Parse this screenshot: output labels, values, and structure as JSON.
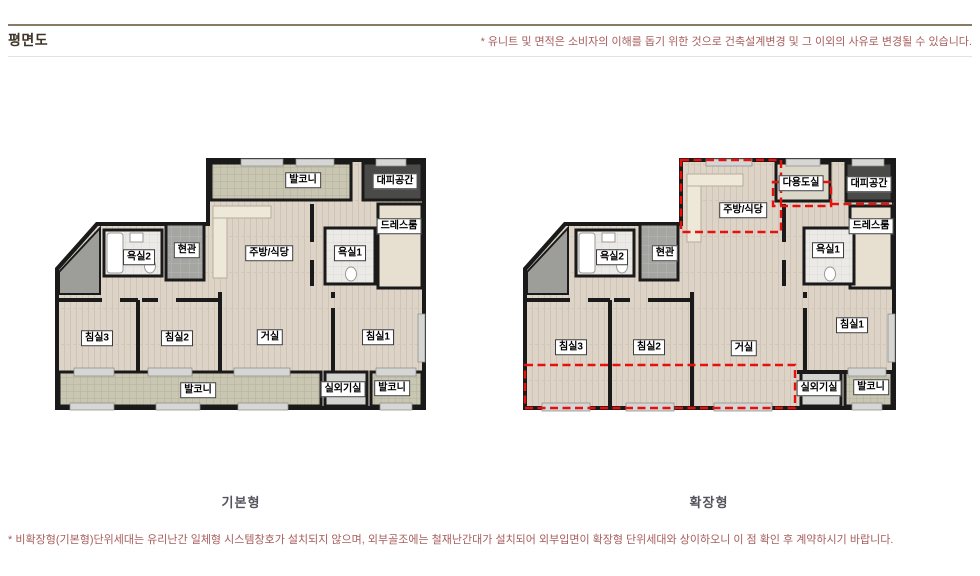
{
  "header": {
    "title": "평면도",
    "note": "* 유니트 및 면적은 소비자의 이해를 돕기 위한 것으로 건축설계변경 및 그 이외의 사유로 변경될 수 있습니다."
  },
  "footer": {
    "note": "* 비확장형(기본형)단위세대는 유리난간 일체형 시스템창호가 설치되지 않으며, 외부골조에는 철재난간대가 설치되어 외부입면이 확장형 단위세대와 상이하오니 이 점 확인 후 계약하시기 바랍니다."
  },
  "plans": {
    "basic": {
      "caption": "기본형",
      "labels": {
        "balcony_top": "발코니",
        "evacuation": "대피공간",
        "dressroom": "드레스룸",
        "bathroom2": "욕실2",
        "entrance": "현관",
        "kitchen": "주방/식당",
        "bathroom1": "욕실1",
        "bedroom3": "침실3",
        "bedroom2": "침실2",
        "living": "거실",
        "bedroom1": "침실1",
        "balcony_bottom": "발코니",
        "outdoor_unit": "실외기실",
        "balcony_right": "발코니"
      }
    },
    "extended": {
      "caption": "확장형",
      "labels": {
        "kitchen": "주방/식당",
        "utility": "다용도실",
        "evacuation": "대피공간",
        "dressroom": "드레스룸",
        "bathroom2": "욕실2",
        "entrance": "현관",
        "bathroom1": "욕실1",
        "bedroom3": "침실3",
        "bedroom2": "침실2",
        "living": "거실",
        "bedroom1": "침실1",
        "outdoor_unit": "실외기실",
        "balcony_right": "발코니"
      }
    }
  },
  "colors": {
    "note_text": "#a85d5d",
    "header_line": "#8a7a64",
    "caption_text": "#54545e",
    "extension_dash": "#e8100c",
    "wall": "#1a1a1a",
    "wood_floor": "#ddd4c7",
    "tile_balcony": "#c9c6b2",
    "entrance_tile": "#a5a5a2",
    "bathroom_tile": "#eceae6"
  }
}
